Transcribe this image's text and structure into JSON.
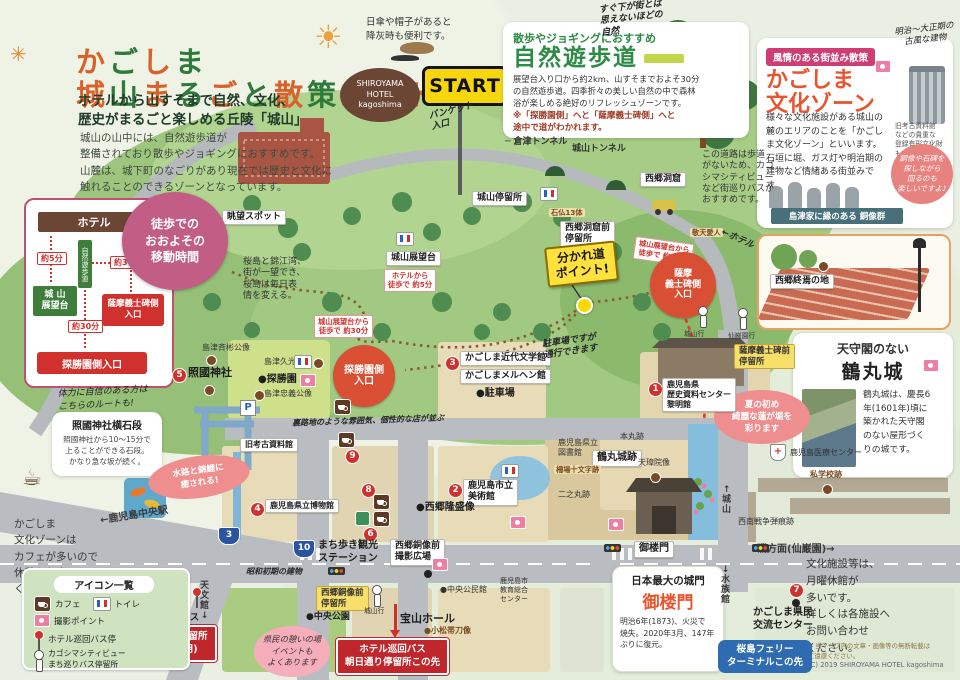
{
  "header": {
    "title_line1": "かごしま",
    "title_line2": "城山まるごと散策ガイド",
    "title_colors": [
      "#d9622b",
      "#2f7a3b"
    ],
    "subtitle": "ホテルから山すそまで自然、文化、\n歴史がまるごと楽しめる丘陵「城山」",
    "body": "城山の山中には、自然遊歩道が\n整備されており散歩やジョギングにおすすめです。\n山麓は、城下町のなごりがあり現在では歴史と文化に\n触れることのできるゾーンとなっています。",
    "spark": "✳"
  },
  "notes": {
    "sun_icon": "☀",
    "sun_note": "日傘や帽子があると\n降灰時も便利です。",
    "hotel_bubble": "SHIROYAMA\nHOTEL\nkagoshima",
    "start_label": "START",
    "coffee_icon": "☕",
    "coffee_icon2": "☕"
  },
  "trail_panel": {
    "tag": "散歩やジョギングにおすすめ",
    "title": "自然遊歩道",
    "body": "展望台入り口から約2km、山すそまでおよそ30分\nの自然遊歩道。四季折々の美しい自然の中で森林\n浴が楽しめる絶好のリフレッシュゾーンです。",
    "note": "※「探勝園側」へと「薩摩義士碑側」へと\n途中で道がわかれます。"
  },
  "culture_panel": {
    "tag": "風情のある街並み散策",
    "title": "かごしま\n文化ゾーン",
    "hand_note": "明治〜大正期の\n古風な建物",
    "building_caption": "旧考古資料館\nなどの貴重な\n登録有形文化財も!",
    "body": "様々な文化施設がある城山の麓のエリアのことを「かごしま文化ゾーン」といいます。石垣に堀、ガス灯や明治期の建物など情緒ある街並みです。",
    "bubble": "銅像や石碑を\n探しながら\n回るのも\n楽しいですよ♪",
    "statues_caption": "島津家に縁のある 銅像群"
  },
  "walk_panel": {
    "badge": "徒歩での\nおおよその\n移動時間",
    "hotel": "ホテル",
    "t5": "約5分",
    "t30a": "約30分",
    "t30b": "約30分",
    "ribbon": "自然遊歩道",
    "observatory": "城 山\n展望台",
    "gishi": "薩摩義士碑側\n入口",
    "tansho": "探勝園側入口"
  },
  "stone_steps": {
    "hand": "体力に自信のある方は\nこちらのルートも!",
    "title": "照國神社横石段",
    "body": "照國神社から10〜15分で\n上ることができる石段。\nかなり急な坂が続く。"
  },
  "cafe_note": "かごしま\n文化ゾーンは\nカフェが多いので\n休憩もお楽しみ\nください。",
  "legend": {
    "title": "アイコン一覧",
    "cafe": "カフェ",
    "toilet": "トイレ",
    "photo": "撮影ポイント",
    "hotel_bus": "ホテル巡回バス停",
    "city_view": "カゴシマシティビュー\nまち巡りバス停留所"
  },
  "tsurumaru_panel": {
    "title1": "天守閣のない",
    "title2": "鶴丸城",
    "body": "鶴丸城は、慶長6\n年(1601年)頃に\n築かれた天守閣\nのない屋形づく\nりの城です。"
  },
  "goromon_panel": {
    "title1": "日本最大の城門",
    "title2": "御楼門",
    "body": "明治6年(1873)、火災で\n焼失。2020年3月、147年\nぶりに復元。"
  },
  "right_note": "文化施設等は、\n月曜休館が\n多いです。\n詳しくは各施設へ\nお問い合わせ\nください。",
  "footer": {
    "line1": "◆ 当マップ内の文章・画像等の無断転載は\nご遠慮ください。",
    "line2": "(C) 2019 SHIROYAMA HOTEL kagoshima"
  },
  "map": {
    "items": [
      {
        "t": "hand",
        "x": 600,
        "y": 2,
        "tx": "すぐ下が街とは\n思えないほどの\n自然",
        "r": -6
      },
      {
        "t": "plain",
        "x": 702,
        "y": 150,
        "tx": "この道路は歩道\nがないため、カゴ\nシマシティビュー\nなど街巡りバスが\nおすすめです。",
        "s": 9
      },
      {
        "t": "hand",
        "x": 430,
        "y": 106,
        "tx": "バンケット\n入口",
        "r": -14
      },
      {
        "t": "plain",
        "x": 505,
        "y": 137,
        "tx": "─ 倉津トンネル",
        "s": 9,
        "b": 1
      },
      {
        "t": "plain",
        "x": 572,
        "y": 144,
        "tx": "城山トンネル",
        "s": 9,
        "b": 1
      },
      {
        "t": "wl",
        "x": 222,
        "y": 210,
        "tx": "眺望スポット"
      },
      {
        "t": "wl",
        "x": 472,
        "y": 191,
        "tx": "城山停留所"
      },
      {
        "t": "wl",
        "x": 640,
        "y": 172,
        "tx": "西郷洞窟"
      },
      {
        "t": "wl",
        "x": 560,
        "y": 221,
        "tx": "西郷洞窟前\n停留所"
      },
      {
        "t": "tanlabel",
        "x": 549,
        "y": 208,
        "tx": "石仏13体"
      },
      {
        "t": "tanlabel",
        "x": 690,
        "y": 228,
        "tx": "敬天愛人"
      },
      {
        "t": "wl",
        "x": 386,
        "y": 251,
        "tx": "城山展望台"
      },
      {
        "t": "rtag",
        "x": 384,
        "y": 269,
        "tx": "ホテルから\n徒歩で 約5分"
      },
      {
        "t": "plain",
        "x": 243,
        "y": 257,
        "tx": "桜島と錦江湾、\n街が一望でき、\n桜島は毎日表\n情を変える。",
        "s": 9
      },
      {
        "t": "rtag",
        "x": 314,
        "y": 315,
        "tx": "城山展望台から\n徒歩で 約30分"
      },
      {
        "t": "rtag",
        "x": 634,
        "y": 240,
        "tx": "城山展望台から\n徒歩で 約30分",
        "r": 8
      },
      {
        "t": "ysign",
        "x": 546,
        "y": 244,
        "tx": "分かれ道\nポイント!",
        "r": -6
      },
      {
        "t": "fork",
        "x": 576,
        "y": 297
      },
      {
        "t": "rcirc",
        "x": 333,
        "y": 345,
        "tx": "探勝園側\n入口",
        "d": 62
      },
      {
        "t": "rcirc",
        "x": 650,
        "y": 252,
        "tx": "薩摩\n義士碑側\n入口",
        "d": 66,
        "s": 9
      },
      {
        "t": "hand",
        "x": 720,
        "y": 234,
        "tx": "←ホテル",
        "r": 24
      },
      {
        "t": "wl",
        "x": 770,
        "y": 274,
        "tx": "西郷終焉の地"
      },
      {
        "t": "dotb",
        "x": 818,
        "y": 261
      },
      {
        "t": "yl",
        "x": 734,
        "y": 344,
        "tx": "薩摩義士碑前\n停留所"
      },
      {
        "t": "busw",
        "x": 698,
        "y": 306
      },
      {
        "t": "busw",
        "x": 738,
        "y": 308
      },
      {
        "t": "tiny",
        "x": 684,
        "y": 330,
        "tx": "城山行"
      },
      {
        "t": "tiny",
        "x": 728,
        "y": 332,
        "tx": "仙巌園行"
      },
      {
        "t": "pinkoval",
        "x": 714,
        "y": 390,
        "tx": "夏の初め\n綺麗な蓮が堀を\n彩ります",
        "w": 80
      },
      {
        "t": "num",
        "x": 172,
        "y": 368,
        "tx": "5"
      },
      {
        "t": "name",
        "x": 188,
        "y": 366,
        "tx": "照國神社",
        "s": 11
      },
      {
        "t": "dotb",
        "x": 204,
        "y": 385
      },
      {
        "t": "plain",
        "x": 202,
        "y": 343,
        "tx": "島津斉彬公像",
        "s": 8
      },
      {
        "t": "dotb",
        "x": 206,
        "y": 355
      },
      {
        "t": "plain",
        "x": 264,
        "y": 357,
        "tx": "島津久光公像",
        "s": 8
      },
      {
        "t": "dotb",
        "x": 313,
        "y": 358
      },
      {
        "t": "name",
        "x": 258,
        "y": 374,
        "tx": "●探勝園"
      },
      {
        "t": "plain",
        "x": 264,
        "y": 389,
        "tx": "島津忠義公像",
        "s": 8
      },
      {
        "t": "dotb",
        "x": 254,
        "y": 390
      },
      {
        "t": "park",
        "x": 240,
        "y": 400,
        "tx": "P"
      },
      {
        "t": "cam",
        "x": 300,
        "y": 374
      },
      {
        "t": "wc",
        "x": 294,
        "y": 355
      },
      {
        "t": "wl",
        "x": 240,
        "y": 438,
        "tx": "旧考古資料館",
        "s": 8
      },
      {
        "t": "hand",
        "x": 292,
        "y": 416,
        "tx": "裏路地のような雰囲気、個性的な店が並ぶ",
        "s": 8,
        "r": -2
      },
      {
        "t": "num",
        "x": 445,
        "y": 356,
        "tx": "3"
      },
      {
        "t": "wl",
        "x": 460,
        "y": 351,
        "tx": "かごしま近代文学館"
      },
      {
        "t": "wl",
        "x": 460,
        "y": 369,
        "tx": "かごしまメルヘン館"
      },
      {
        "t": "name",
        "x": 476,
        "y": 388,
        "tx": "●駐車場"
      },
      {
        "t": "hand",
        "x": 543,
        "y": 336,
        "tx": "駐車場ですが\n通行できます",
        "r": -8
      },
      {
        "t": "num",
        "x": 648,
        "y": 382,
        "tx": "1"
      },
      {
        "t": "wl",
        "x": 662,
        "y": 378,
        "tx": "鹿児島県\n歴史資料センター\n黎明館",
        "s": 8
      },
      {
        "t": "plain",
        "x": 558,
        "y": 438,
        "tx": "鹿児島県立\n図書館",
        "s": 8
      },
      {
        "t": "wl",
        "x": 592,
        "y": 450,
        "tx": "鶴丸城跡",
        "s": 10
      },
      {
        "t": "plain",
        "x": 620,
        "y": 432,
        "tx": "本丸跡",
        "s": 8
      },
      {
        "t": "plain",
        "x": 638,
        "y": 458,
        "tx": "天璋院像",
        "s": 8
      },
      {
        "t": "dotb",
        "x": 650,
        "y": 472
      },
      {
        "t": "tanlabel",
        "x": 554,
        "y": 465,
        "tx": "柵場十文字跡"
      },
      {
        "t": "plain",
        "x": 558,
        "y": 490,
        "tx": "二之丸跡",
        "s": 8
      },
      {
        "t": "browntext",
        "x": 810,
        "y": 470,
        "tx": "私学校跡",
        "s": 8
      },
      {
        "t": "dotb",
        "x": 822,
        "y": 484
      },
      {
        "t": "hosp",
        "x": 770,
        "y": 444,
        "tx": "+"
      },
      {
        "t": "plain",
        "x": 790,
        "y": 448,
        "tx": "鹿児島医療センター",
        "s": 8
      },
      {
        "t": "plain",
        "x": 738,
        "y": 517,
        "tx": "西南戦争弾痕跡",
        "s": 8
      },
      {
        "t": "roadv",
        "x": 722,
        "y": 486,
        "tx": "↑\n城\n山",
        "s": 9
      },
      {
        "t": "num",
        "x": 448,
        "y": 483,
        "tx": "2"
      },
      {
        "t": "wl",
        "x": 463,
        "y": 479,
        "tx": "鹿児島市立\n美術館",
        "s": 9
      },
      {
        "t": "name",
        "x": 416,
        "y": 502,
        "tx": "●西郷隆盛像"
      },
      {
        "t": "cam",
        "x": 510,
        "y": 516
      },
      {
        "t": "cam",
        "x": 608,
        "y": 518
      },
      {
        "t": "num",
        "x": 250,
        "y": 502,
        "tx": "4"
      },
      {
        "t": "wl",
        "x": 265,
        "y": 499,
        "tx": "鹿児島県立博物館",
        "s": 8
      },
      {
        "t": "wc",
        "x": 214,
        "y": 462
      },
      {
        "t": "wc",
        "x": 501,
        "y": 464
      },
      {
        "t": "wc",
        "x": 540,
        "y": 187
      },
      {
        "t": "wc",
        "x": 396,
        "y": 232
      },
      {
        "t": "cafe",
        "x": 334,
        "y": 399
      },
      {
        "t": "cafe",
        "x": 338,
        "y": 432
      },
      {
        "t": "num",
        "x": 345,
        "y": 449,
        "tx": "9"
      },
      {
        "t": "num",
        "x": 361,
        "y": 483,
        "tx": "8"
      },
      {
        "t": "cafe",
        "x": 373,
        "y": 494
      },
      {
        "t": "info",
        "x": 355,
        "y": 511
      },
      {
        "t": "cafe",
        "x": 373,
        "y": 511
      },
      {
        "t": "num",
        "x": 363,
        "y": 527,
        "tx": "6"
      },
      {
        "t": "shield",
        "x": 293,
        "y": 540,
        "tx": "10"
      },
      {
        "t": "name",
        "x": 318,
        "y": 540,
        "tx": "まち歩き観光\nステーション",
        "s": 10
      },
      {
        "t": "wl",
        "x": 390,
        "y": 539,
        "tx": "西郷銅像前\n撮影広場",
        "s": 9
      },
      {
        "t": "cam",
        "x": 432,
        "y": 558
      },
      {
        "t": "dotblk",
        "x": 424,
        "y": 570
      },
      {
        "t": "yl",
        "x": 316,
        "y": 586,
        "tx": "西郷銅像前\n停留所"
      },
      {
        "t": "busw",
        "x": 372,
        "y": 585
      },
      {
        "t": "tiny",
        "x": 364,
        "y": 607,
        "tx": "城山行"
      },
      {
        "t": "name",
        "x": 306,
        "y": 612,
        "tx": "●中央公園",
        "s": 9
      },
      {
        "t": "pinkbub",
        "x": 254,
        "y": 626,
        "tx": "県民の憩いの場\nイベントも\nよくあります"
      },
      {
        "t": "hand",
        "x": 246,
        "y": 567,
        "tx": "昭和初期の建物",
        "s": 8
      },
      {
        "t": "name",
        "x": 400,
        "y": 612,
        "tx": "宝山ホール",
        "s": 11
      },
      {
        "t": "plain",
        "x": 440,
        "y": 585,
        "tx": "●中央公民館",
        "s": 8
      },
      {
        "t": "browntext",
        "x": 424,
        "y": 626,
        "tx": "●小松帯刀像",
        "s": 8
      },
      {
        "t": "plain",
        "x": 500,
        "y": 577,
        "tx": "鹿児島市\n教育総合\nセンター",
        "s": 7
      },
      {
        "t": "redarrow",
        "x": 394,
        "y": 604
      },
      {
        "t": "rl",
        "x": 336,
        "y": 638,
        "tx": "ホテル巡回バス\n朝日通り停留所この先"
      },
      {
        "t": "roadh",
        "x": 100,
        "y": 510,
        "tx": "←鹿児島中央駅",
        "r": -9
      },
      {
        "t": "shield",
        "x": 218,
        "y": 527,
        "tx": "3"
      },
      {
        "t": "roadv",
        "x": 200,
        "y": 582,
        "tx": "天\n文\n館\n↓",
        "s": 9
      },
      {
        "t": "busr",
        "x": 192,
        "y": 587
      },
      {
        "t": "name",
        "x": 136,
        "y": 613,
        "tx": "ホテル巡回バス",
        "s": 9
      },
      {
        "t": "rl",
        "x": 132,
        "y": 625,
        "tx": "照国通り停留所\n(降車専用)"
      },
      {
        "t": "pinkoval",
        "x": 148,
        "y": 456,
        "tx": "水路と錦鯉に\n癒される!",
        "w": 86,
        "r": -8
      },
      {
        "t": "wl",
        "x": 634,
        "y": 541,
        "tx": "御楼門",
        "s": 10
      },
      {
        "t": "roadh",
        "x": 757,
        "y": 544,
        "tx": "磯方面(仙巌園)→"
      },
      {
        "t": "roadv",
        "x": 721,
        "y": 566,
        "tx": "↓\n水\n族\n館",
        "s": 9
      },
      {
        "t": "bluebox",
        "x": 718,
        "y": 640,
        "tx": "桜島フェリー\nターミナルこの先"
      },
      {
        "t": "num",
        "x": 789,
        "y": 583,
        "tx": "7"
      },
      {
        "t": "dotblk",
        "x": 792,
        "y": 599
      },
      {
        "t": "name",
        "x": 753,
        "y": 607,
        "tx": "かごしま県民\n交流センター",
        "s": 10
      },
      {
        "t": "tl",
        "x": 328,
        "y": 567
      },
      {
        "t": "tl",
        "x": 604,
        "y": 544
      },
      {
        "t": "tl",
        "x": 752,
        "y": 544
      }
    ]
  }
}
